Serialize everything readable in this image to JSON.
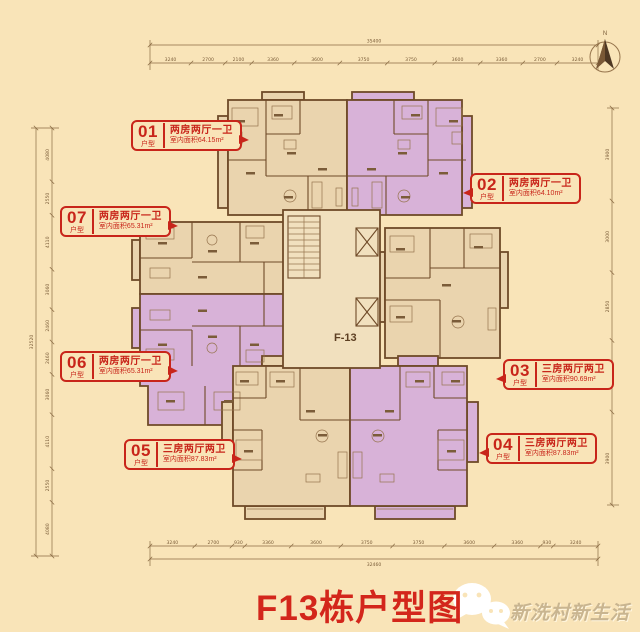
{
  "title": {
    "text": "F13栋户型图"
  },
  "wechat": {
    "caption": "新洗村新生活"
  },
  "compass": {
    "label": "N"
  },
  "plan": {
    "building_label": "F-13"
  },
  "units": [
    {
      "num": "01",
      "tag": "户型",
      "type": "两房两厅一卫",
      "area": "室内面积64.15m²"
    },
    {
      "num": "02",
      "tag": "户型",
      "type": "两房两厅一卫",
      "area": "室内面积64.10m²"
    },
    {
      "num": "03",
      "tag": "户型",
      "type": "三房两厅两卫",
      "area": "室内面积90.69m²"
    },
    {
      "num": "04",
      "tag": "户型",
      "type": "三房两厅两卫",
      "area": "室内面积87.83m²"
    },
    {
      "num": "05",
      "tag": "户型",
      "type": "三房两厅两卫",
      "area": "室内面积87.83m²"
    },
    {
      "num": "06",
      "tag": "户型",
      "type": "两房两厅一卫",
      "area": "室内面积65.31m²"
    },
    {
      "num": "07",
      "tag": "户型",
      "type": "两房两厅一卫",
      "area": "室内面积65.31m²"
    }
  ],
  "dims": {
    "top": {
      "total": "35400",
      "segments": [
        "3240",
        "2700",
        "2100",
        "3360",
        "3600",
        "3750",
        "3750",
        "3600",
        "3360",
        "2700",
        "3240"
      ]
    },
    "bottom": {
      "total": "32460",
      "segments": [
        "3240",
        "2700",
        "930",
        "3360",
        "3600",
        "3750",
        "3750",
        "3600",
        "3360",
        "930",
        "3240"
      ]
    },
    "left": {
      "total": "32520",
      "segments": [
        "4080",
        "2550",
        "4110",
        "3060",
        "2460",
        "2460",
        "3060",
        "4110",
        "2550",
        "4080"
      ]
    },
    "right": {
      "segments": [
        "3900",
        "3000",
        "2850",
        "3000",
        "3900"
      ]
    }
  },
  "colors": {
    "background": "#F9E4B8",
    "accent_red": "#C8251A",
    "unit_tan": "#EAD4AE",
    "unit_purple": "#D8B2D8",
    "wall_brown": "#6F4A28"
  }
}
